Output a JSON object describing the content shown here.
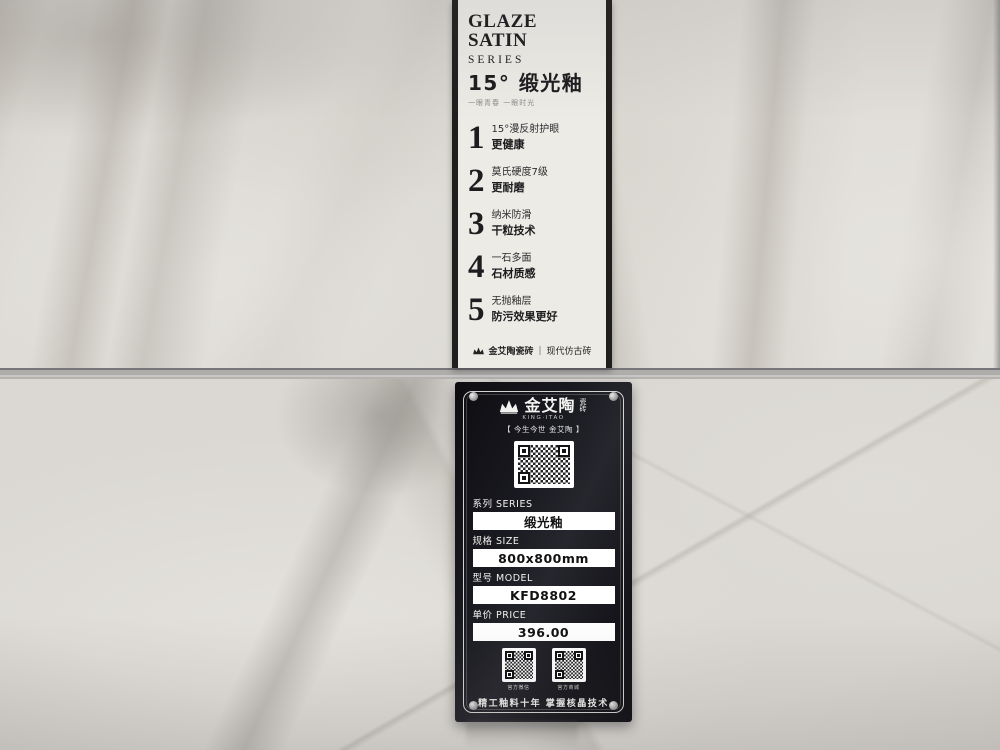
{
  "banner": {
    "title_en": "GLAZE SATIN",
    "subtitle_en": "SERIES",
    "title_cn": "15° 缎光釉",
    "tagline": "一眼青春 一眼时光",
    "features": [
      {
        "num": "1",
        "line1": "15°漫反射护眼",
        "line2": "更健康"
      },
      {
        "num": "2",
        "line1": "莫氏硬度7级",
        "line2": "更耐磨"
      },
      {
        "num": "3",
        "line1": "纳米防滑",
        "line2": "干粒技术"
      },
      {
        "num": "4",
        "line1": "一石多面",
        "line2": "石材质感"
      },
      {
        "num": "5",
        "line1": "无抛釉层",
        "line2": "防污效果更好"
      }
    ],
    "footer_brand": "金艾陶瓷砖",
    "footer_divider": "|",
    "footer_tag": "现代仿古砖"
  },
  "placard": {
    "brand": "金艾陶",
    "brand_small": "瓷砖",
    "brand_en": "KING·ITAO",
    "slogan": "【 今生今世 金艾陶 】",
    "fields": [
      {
        "label": "系列 SERIES",
        "value": "缎光釉"
      },
      {
        "label": "规格 SIZE",
        "value": "800x800mm"
      },
      {
        "label": "型号 MODEL",
        "value": "KFD8802"
      },
      {
        "label": "单价 PRICE",
        "value": "396.00"
      }
    ],
    "qr_captions": [
      "官方微信",
      "官方商城"
    ],
    "footer": "精工釉料十年 掌握核晶技术"
  },
  "colors": {
    "banner_bg": "#edebe6",
    "banner_text": "#1c1c1e",
    "placard_bg": "#17171c",
    "placard_text": "#f4f4f2",
    "value_box_bg": "#ffffff",
    "value_box_text": "#121212",
    "tile_light": "#dcd9d4",
    "grout": "#9a9997"
  }
}
